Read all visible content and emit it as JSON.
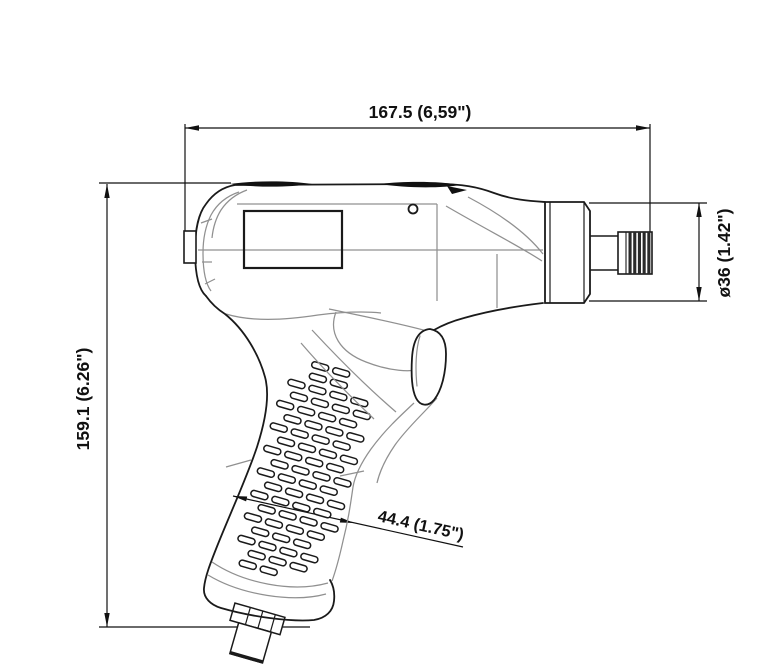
{
  "drawing": {
    "subject": "pistol-grip-tool-side-view",
    "dimensions": {
      "overall_length": "167.5 (6,59\")",
      "overall_height": "159.1 (6.26\")",
      "spindle_diameter": "ø36 (1.42\")",
      "grip_width": "44.4 (1.75\")"
    },
    "colors": {
      "outline": "#1a1a1a",
      "construction": "#909090",
      "background": "#ffffff"
    }
  }
}
